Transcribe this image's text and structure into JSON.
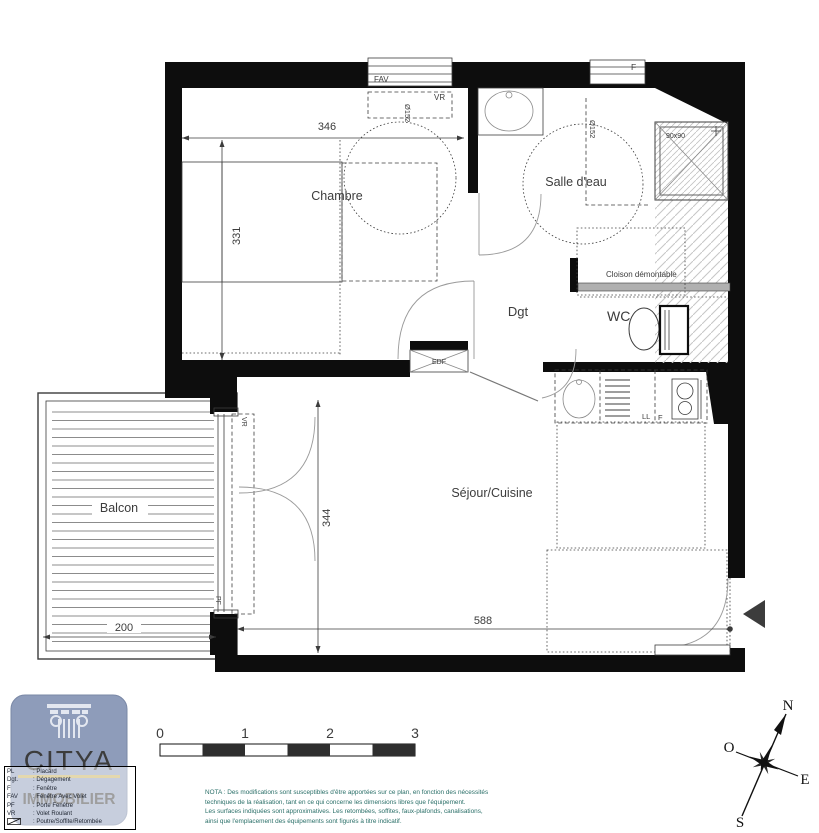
{
  "plan": {
    "rooms": {
      "chambre": "Chambre",
      "salle_deau": "Salle d'eau",
      "wc": "WC",
      "dgt": "Dgt",
      "sejour": "Séjour/Cuisine",
      "balcon": "Balcon"
    },
    "dimensions_cm": {
      "chambre_width": "346",
      "chambre_depth": "331",
      "sejour_depth": "344",
      "sejour_width": "588",
      "balcon_width": "200"
    },
    "annotations": {
      "window_fav": "FAV",
      "shutter_top": "VR",
      "window_f": "F",
      "turning_circle_chambre": "Ø152",
      "turning_circle_sdb": "Ø152",
      "shower_size": "90x90",
      "removable_partition": "Cloison démontable",
      "electric_panel": "EDF",
      "washer": "LL",
      "fridge": "F",
      "shutter_balcony": "VR",
      "french_window": "PF"
    }
  },
  "footer": {
    "logo": {
      "brand_line1": "CITYA",
      "brand_line2": "IMMOBILIER"
    },
    "legend": {
      "rows": [
        {
          "abbr": "PL",
          "desc": ": Placard"
        },
        {
          "abbr": "Dgt.",
          "desc": ": Dégagement"
        },
        {
          "abbr": "F",
          "desc": ": Fenêtre"
        },
        {
          "abbr": "FAV",
          "desc": ": Fenêtre Avec Volet"
        },
        {
          "abbr": "PF",
          "desc": ": Porte Fenêtre"
        },
        {
          "abbr": "VR",
          "desc": ": Volet Roulant"
        },
        {
          "abbr": "",
          "desc": ": Poutre/Soffite/Retombée"
        }
      ]
    },
    "scale_bar": {
      "ticks": [
        "0",
        "1",
        "2",
        "3"
      ]
    },
    "nota": {
      "line1": "NOTA : Des modifications sont susceptibles d'être apportées sur ce plan, en fonction des nécessités",
      "line2": "techniques de la réalisation, tant en ce qui concerne les dimensions libres que l'équipement.",
      "line3": "Les surfaces indiquées sont approximatives. Les retombées, soffites, faux-plafonds, canalisations,",
      "line4": "ainsi que l'emplacement des équipements sont figurés à titre indicatif."
    },
    "compass": {
      "north": "N",
      "west": "O",
      "east": "E",
      "south": "S"
    }
  },
  "colors": {
    "wall_black": "#0d0d0d",
    "logo_bg": "#8e9cba",
    "logo_gold": "#c9b05c",
    "nota_text": "#2a6f68",
    "partition_gray": "#b0b0b0"
  }
}
